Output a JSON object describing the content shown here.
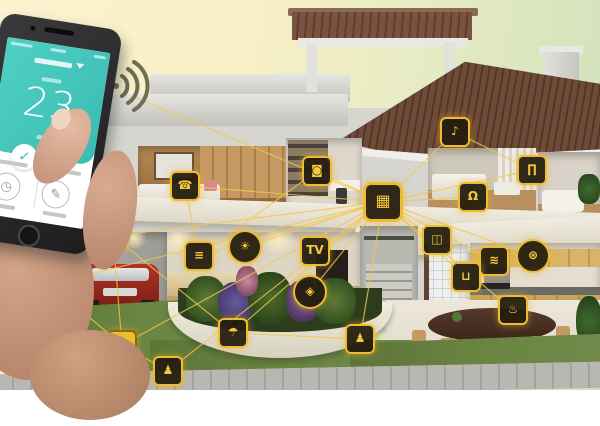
{
  "colors": {
    "accent_yellow": "#f0bd2e",
    "node_border": "#eebc33",
    "line_yellow": "#f3c84e",
    "app_teal": "#3bbcb2",
    "grass_green": "#66813e",
    "roof_brown": "#6e4b38"
  },
  "phone": {
    "temperature": "23",
    "shield_check": "✓",
    "app_icons": [
      {
        "name": "scene-timer-icon",
        "glyph": "◷"
      },
      {
        "name": "edit-pencil-icon",
        "glyph": "✎"
      }
    ]
  },
  "network": {
    "hub_id": "hub",
    "phone_anchor": {
      "x": 132,
      "y": 96
    }
  },
  "devices": [
    {
      "id": "hub",
      "name": "smart-home-hub",
      "glyph": "▦",
      "x": 383,
      "y": 202,
      "shape": "square"
    },
    {
      "id": "intercom",
      "name": "bedroom-intercom",
      "glyph": "☎",
      "x": 185,
      "y": 186,
      "shape": "square"
    },
    {
      "id": "washer",
      "name": "washing-machine",
      "glyph": "◙",
      "x": 317,
      "y": 171,
      "shape": "square"
    },
    {
      "id": "blinds",
      "name": "living-room-blinds",
      "glyph": "≡",
      "x": 199,
      "y": 256,
      "shape": "square"
    },
    {
      "id": "light",
      "name": "ceiling-light",
      "glyph": "☀",
      "x": 245,
      "y": 247,
      "shape": "circle"
    },
    {
      "id": "tv",
      "name": "television",
      "glyph": "TV",
      "x": 315,
      "y": 251,
      "shape": "square"
    },
    {
      "id": "doorbell",
      "name": "roof-doorbell",
      "glyph": "♪",
      "x": 455,
      "y": 132,
      "shape": "square"
    },
    {
      "id": "curtain",
      "name": "bedroom-curtain",
      "glyph": "∏",
      "x": 532,
      "y": 170,
      "shape": "square"
    },
    {
      "id": "door-lock",
      "name": "door-lock",
      "glyph": "Ω",
      "x": 473,
      "y": 197,
      "shape": "square"
    },
    {
      "id": "window",
      "name": "smart-window",
      "glyph": "◫",
      "x": 437,
      "y": 240,
      "shape": "square"
    },
    {
      "id": "fan",
      "name": "ventilation-fan",
      "glyph": "⊛",
      "x": 533,
      "y": 256,
      "shape": "circle"
    },
    {
      "id": "faucet",
      "name": "kitchen-faucet",
      "glyph": "≋",
      "x": 494,
      "y": 261,
      "shape": "square"
    },
    {
      "id": "bathtub",
      "name": "bathroom-tub",
      "glyph": "⊔",
      "x": 466,
      "y": 277,
      "shape": "square"
    },
    {
      "id": "cooktop",
      "name": "smart-cooktop",
      "glyph": "♨",
      "x": 513,
      "y": 310,
      "shape": "square"
    },
    {
      "id": "camera",
      "name": "security-camera",
      "glyph": "◉",
      "x": 113,
      "y": 236,
      "shape": "square"
    },
    {
      "id": "smart-plug",
      "name": "garage-smart-plug",
      "glyph": "↯",
      "x": 50,
      "y": 284,
      "shape": "square"
    },
    {
      "id": "garage-door",
      "name": "garage-door-opener",
      "glyph": "▤",
      "x": 122,
      "y": 345,
      "shape": "square",
      "filled": true
    },
    {
      "id": "motion-sensor",
      "name": "outdoor-motion-sensor",
      "glyph": "♟",
      "x": 168,
      "y": 371,
      "shape": "square"
    },
    {
      "id": "sprinkler",
      "name": "garden-sprinkler",
      "glyph": "☂",
      "x": 233,
      "y": 333,
      "shape": "square"
    },
    {
      "id": "entry-sensor",
      "name": "entry-sensor",
      "glyph": "◈",
      "x": 310,
      "y": 292,
      "shape": "circle"
    },
    {
      "id": "presence",
      "name": "yard-presence-sensor",
      "glyph": "♟",
      "x": 360,
      "y": 339,
      "shape": "square"
    }
  ],
  "links": {
    "extra": [
      [
        "camera",
        "garage-door"
      ],
      [
        "garage-door",
        "motion-sensor"
      ],
      [
        "smart-plug",
        "garage-door"
      ],
      [
        "camera",
        "sprinkler"
      ],
      [
        "doorbell",
        "curtain"
      ],
      [
        "washer",
        "blinds"
      ],
      [
        "sprinkler",
        "presence"
      ],
      [
        "intercom",
        "blinds"
      ]
    ]
  }
}
